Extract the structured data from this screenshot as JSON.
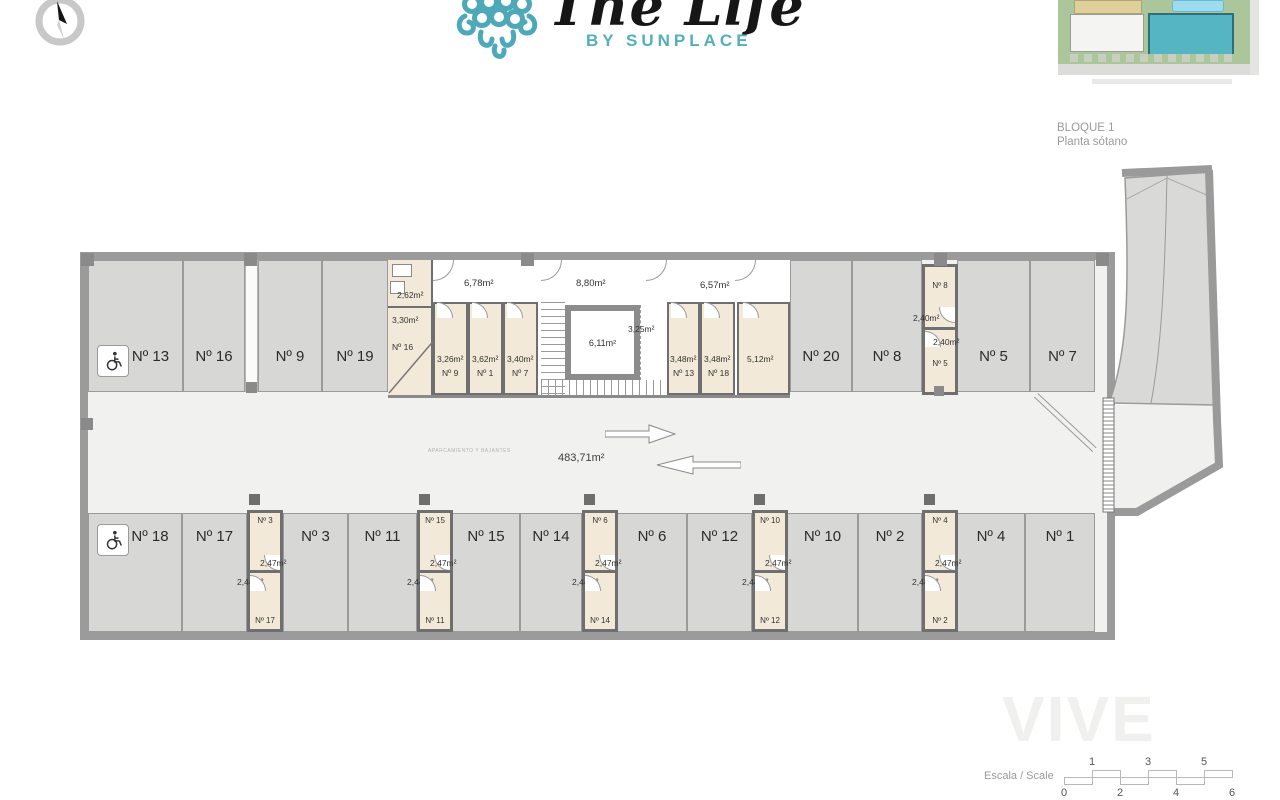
{
  "logo": {
    "title": "The Life",
    "subtitle": "BY SUNPLACE",
    "teal": "#4da9b9"
  },
  "caption": {
    "line1": "BLOQUE 1",
    "line2": "Planta sótano"
  },
  "plan": {
    "area_total": "483,71m²",
    "note": "APARCAMIENTO Y BAJANTES",
    "top_stalls": [
      {
        "label": "Nº 13"
      },
      {
        "label": "Nº 16"
      },
      {
        "label": "Nº 9"
      },
      {
        "label": "Nº 19"
      },
      {
        "label": "Nº 20"
      },
      {
        "label": "Nº 8"
      },
      {
        "label": "Nº 5"
      },
      {
        "label": "Nº 7"
      }
    ],
    "bottom_stalls": [
      {
        "label": "Nº 18"
      },
      {
        "label": "Nº 17"
      },
      {
        "label": "Nº 3"
      },
      {
        "label": "Nº 11"
      },
      {
        "label": "Nº 15"
      },
      {
        "label": "Nº 14"
      },
      {
        "label": "Nº 6"
      },
      {
        "label": "Nº 12"
      },
      {
        "label": "Nº 10"
      },
      {
        "label": "Nº 2"
      },
      {
        "label": "Nº 4"
      },
      {
        "label": "Nº 1"
      }
    ],
    "storage_top": {
      "unit_a": "Nº 8",
      "area_a": "2,40m²",
      "area_b": "2,40m²",
      "unit_b": "Nº 5"
    },
    "storage_cols": [
      {
        "top_unit": "Nº 3",
        "top_area": "2,47m²",
        "bottom_area": "2,44m²",
        "bottom_unit": "Nº 17"
      },
      {
        "top_unit": "Nº 15",
        "top_area": "2,47m²",
        "bottom_area": "2,44m²",
        "bottom_unit": "Nº 11"
      },
      {
        "top_unit": "Nº 6",
        "top_area": "2,47m²",
        "bottom_area": "2,44m²",
        "bottom_unit": "Nº 14"
      },
      {
        "top_unit": "Nº 10",
        "top_area": "2,47m²",
        "bottom_area": "2,44m²",
        "bottom_unit": "Nº 12"
      },
      {
        "top_unit": "Nº 4",
        "top_area": "2,47m²",
        "bottom_area": "2,44m²",
        "bottom_unit": "Nº 2"
      }
    ],
    "core": {
      "room_small": "2,62m²",
      "room_330": "3,30m²",
      "room16": "Nº 16",
      "corridor1": "6,78m²",
      "corridor2": "8,80m²",
      "corridor3": "6,57m²",
      "lift": "6,11m²",
      "landing": "3,25m²",
      "rooms": [
        {
          "area": "3,26m²",
          "unit": "Nº 9"
        },
        {
          "area": "3,62m²",
          "unit": "Nº 1"
        },
        {
          "area": "3,40m²",
          "unit": "Nº 7"
        },
        {
          "area": "3,48m²",
          "unit": "Nº 13"
        },
        {
          "area": "3,48m²",
          "unit": "Nº 18"
        },
        {
          "area": "5,12m²",
          "unit": ""
        }
      ]
    }
  },
  "scale": {
    "label": "Escala / Scale",
    "top": [
      "1",
      "3",
      "5"
    ],
    "bottom": [
      "0",
      "2",
      "4",
      "6"
    ]
  },
  "watermark": "VIVE"
}
